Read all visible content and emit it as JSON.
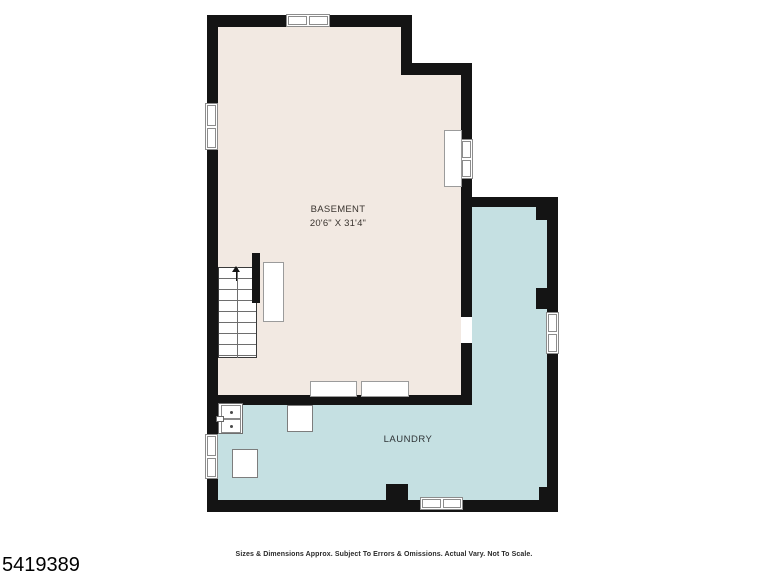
{
  "floorplan": {
    "rooms": [
      {
        "name": "BASEMENT",
        "dimensions": "20'6\" X 31'4\"",
        "fill": "#f2e9e2"
      },
      {
        "name": "LAUNDRY",
        "fill": "#c5e0e2"
      }
    ],
    "colors": {
      "wall": "#141414",
      "room_basement": "#f2e9e2",
      "room_laundry": "#c5e0e2",
      "window_frame": "#8c8c8c",
      "fixture_outline": "#9b9b9b",
      "stair_line": "#6e6e6e",
      "label_text": "#3a342f"
    },
    "features": [
      "staircase-up-icon",
      "up-arrow-icon",
      "laundry-sink-icon",
      "washer-icon",
      "dryer-icon",
      "window-icon x6",
      "door-opening",
      "chimney-block"
    ]
  },
  "footer": {
    "disclaimer": "Sizes & Dimensions Approx. Subject To Errors & Omissions. Actual Vary. Not To Scale.",
    "listing_id": "5419389"
  }
}
